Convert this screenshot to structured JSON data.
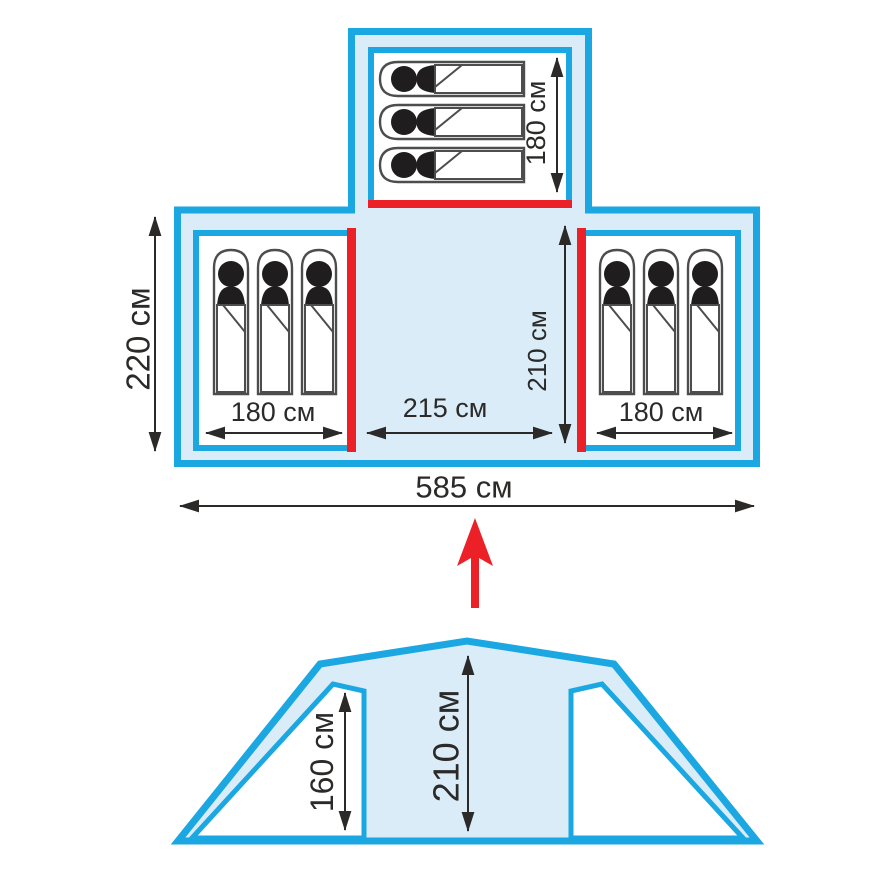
{
  "diagram_title": "Tent layout diagram (floor plan and front elevation)",
  "units": "см",
  "colors": {
    "outline_cyan": "#1ba7e1",
    "fill_light_blue": "#d9ecf8",
    "door_red": "#ec2027",
    "dimension_black": "#2b2a29"
  },
  "floor_plan": {
    "overall_width_label": "585 см",
    "side_depth_label": "220 см",
    "top_room": {
      "sleeping_bag_count": 3,
      "length_label": "180 см",
      "door_side": "bottom"
    },
    "left_room": {
      "sleeping_bag_count": 3,
      "width_label": "180 см",
      "door_side": "right"
    },
    "right_room": {
      "sleeping_bag_count": 3,
      "width_label": "180 см",
      "door_side": "left"
    },
    "center_area": {
      "width_label": "215 см",
      "depth_label": "210 см"
    }
  },
  "elevation": {
    "side_height_label": "160 см",
    "center_height_label": "210 см"
  }
}
